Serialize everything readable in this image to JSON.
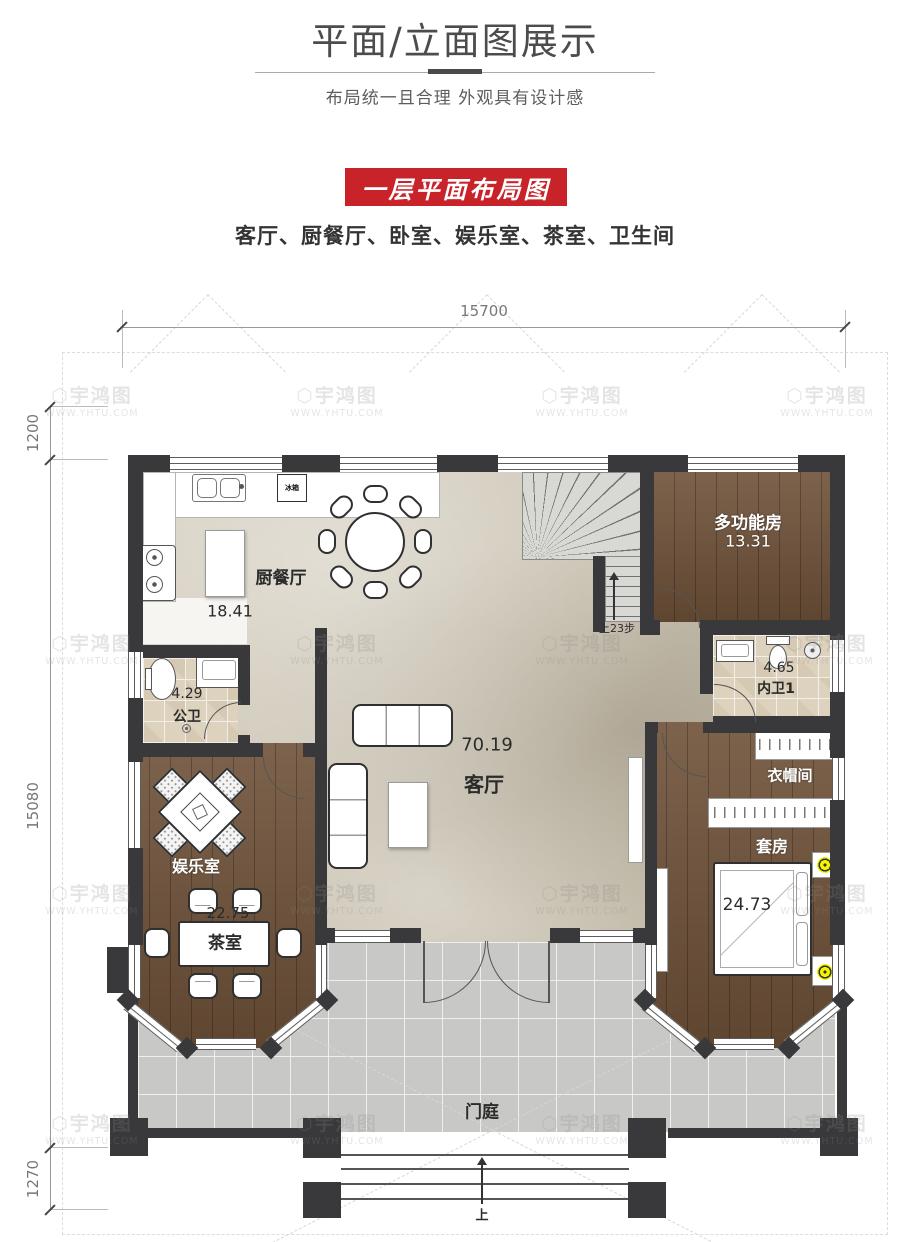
{
  "header": {
    "title": "平面/立面图展示",
    "subtitle": "布局统一且合理 外观具有设计感"
  },
  "banner": {
    "label": "一层平面布局图",
    "bg_color": "#c9232a"
  },
  "room_list": "客厅、厨餐厅、卧室、娱乐室、茶室、卫生间",
  "dimensions": {
    "top": "15700",
    "left_upper": "1200",
    "left_main": "15080",
    "left_lower": "1270"
  },
  "watermark": {
    "icon": "⬡",
    "name": "宇鸿图",
    "url": "WWW.YHTU.COM"
  },
  "plan": {
    "rooms": {
      "kitchen_dining": {
        "name": "厨餐厅",
        "area": "18.41"
      },
      "guest_bath": {
        "name": "公卫",
        "area": "4.29"
      },
      "multi_function": {
        "name": "多功能房",
        "area": "13.31"
      },
      "inner_bath": {
        "name": "内卫1",
        "area": "4.65"
      },
      "living": {
        "name": "客厅",
        "area": "70.19"
      },
      "cloakroom": {
        "name": "衣帽间"
      },
      "suite": {
        "name": "套房",
        "area": "24.73"
      },
      "entertainment": {
        "name": "娱乐室"
      },
      "tea_room": {
        "name": "茶室",
        "area": "22.75"
      },
      "porch": {
        "name": "门庭"
      }
    },
    "annotations": {
      "stairs_up": "上23步",
      "entry_up": "上",
      "fridge": "冰箱"
    }
  }
}
